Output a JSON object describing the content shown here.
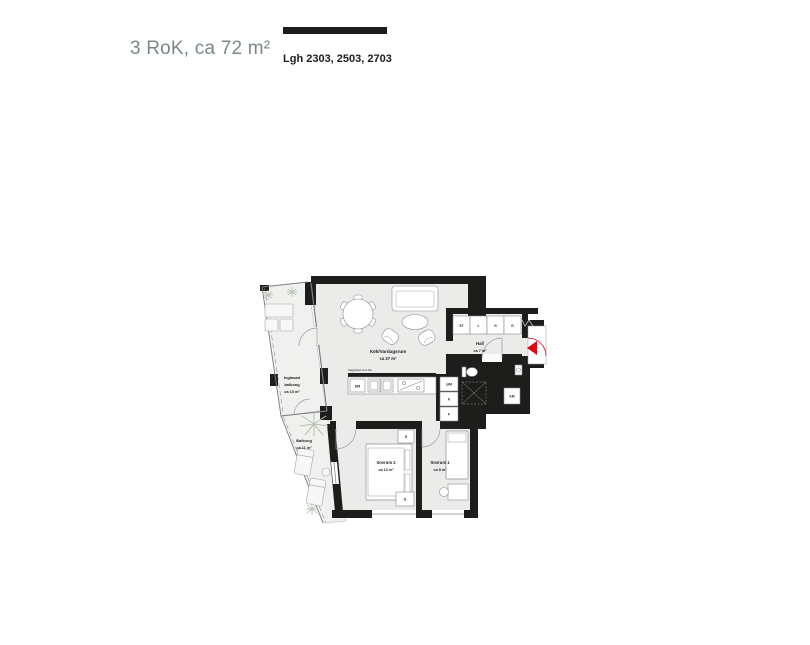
{
  "header": {
    "title": "3 RoK, ca 72 m²",
    "apartments_label": "Lgh 2303, 2503, 2703"
  },
  "floorplan": {
    "rooms": {
      "living": {
        "name": "Kök/Vardagsrum",
        "area": "ca 37 m²"
      },
      "hall": {
        "name": "Hall",
        "area": "ca 7 m²"
      },
      "bath": {
        "name": "Bad/Tvätt",
        "area": "ca 4 m²"
      },
      "bedroom2": {
        "name": "Sovrum 2",
        "area": "ca 13 m²"
      },
      "bedroom1": {
        "name": "Sovrum 1",
        "area": "ca 8 m²"
      },
      "glazed_balcony": {
        "name_line1": "Inglasad",
        "name_line2": "balkong",
        "area": "ca 10 m²"
      },
      "balcony": {
        "name": "Balkong",
        "area": "ca 11 m²"
      }
    },
    "annotations": {
      "wall_height_note": "Vägghöjd ca 0.9m",
      "dishwasher": "DM",
      "washing_machine": "KM",
      "closet_1": "ST",
      "closet_2": "L",
      "closet_3": "G",
      "closet_4": "G",
      "appliance_1": "U/M",
      "appliance_2": "K",
      "appliance_3": "F",
      "wardrobe_top": "G",
      "wardrobe_bottom": "G"
    },
    "colors": {
      "wall": "#1d1d1b",
      "floor": "#ebebea",
      "balcony_floor": "#f0f0ef",
      "entry_accent": "#e30613",
      "title_text": "#7a8a82",
      "plant": "#b5c4af"
    }
  }
}
